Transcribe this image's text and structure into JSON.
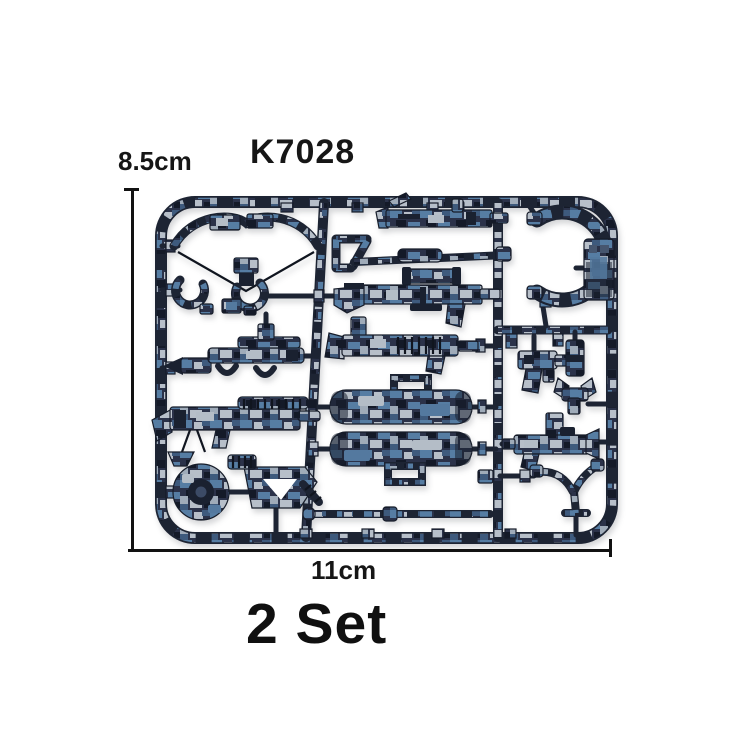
{
  "product_image": {
    "model_number": "K7028",
    "height_label": "8.5cm",
    "width_label": "11cm",
    "quantity_label": "2 Set"
  },
  "sprue": {
    "description": "injection-molded sprue of minifigure weapon accessories in blue digital camouflage",
    "colors": {
      "plastic_dark": "#1d2433",
      "camo_base": "#2b3249",
      "camo_blue": "#54799f",
      "camo_light_gray": "#b4bdc7",
      "camo_black": "#141a28",
      "measure_line": "#121212",
      "text": "#161616",
      "background": "#ffffff"
    },
    "parts": [
      "crossbow",
      "handcuffs",
      "rocket-launcher",
      "machine-gun",
      "saw-disc",
      "drill-gun",
      "rifle",
      "shovel",
      "sniper-rifle",
      "submachine-gun",
      "supply-case-top",
      "supply-case-bottom",
      "rod",
      "curved-hook",
      "id-plate",
      "compact-pistol",
      "magazine",
      "wrench-claw",
      "assault-smg",
      "slingshot"
    ]
  }
}
